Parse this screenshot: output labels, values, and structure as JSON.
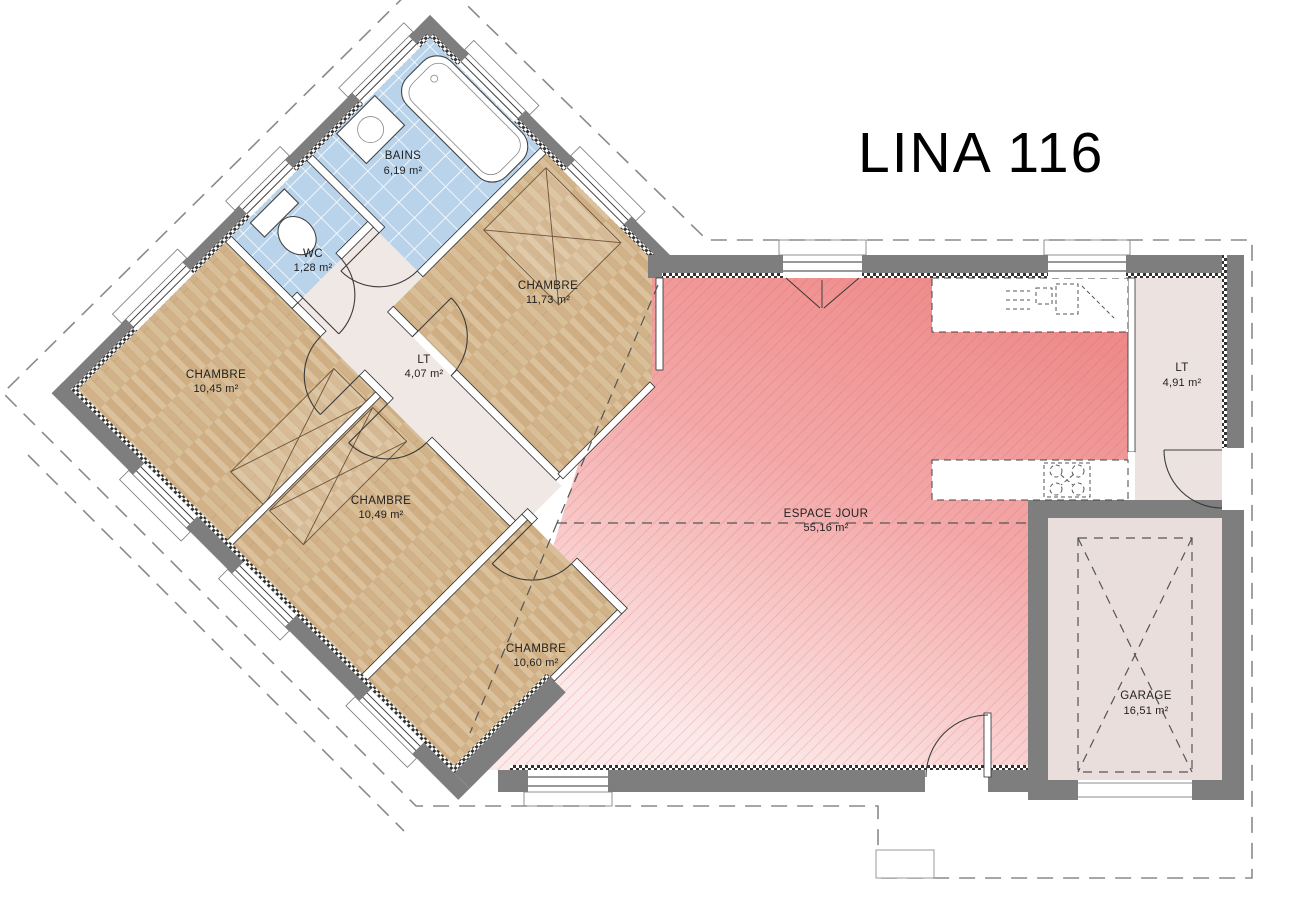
{
  "title": "LINA 116",
  "rooms": [
    {
      "id": "bains",
      "name": "BAINS",
      "area": "6,19 m²"
    },
    {
      "id": "wc",
      "name": "WC",
      "area": "1,28 m²"
    },
    {
      "id": "chambre-1",
      "name": "CHAMBRE",
      "area": "11,73 m²"
    },
    {
      "id": "lt-1",
      "name": "LT",
      "area": "4,07 m²"
    },
    {
      "id": "chambre-2",
      "name": "CHAMBRE",
      "area": "10,45 m²"
    },
    {
      "id": "chambre-3",
      "name": "CHAMBRE",
      "area": "10,49 m²"
    },
    {
      "id": "chambre-4",
      "name": "CHAMBRE",
      "area": "10,60 m²"
    },
    {
      "id": "espace-jour",
      "name": "ESPACE JOUR",
      "area": "55,16 m²"
    },
    {
      "id": "lt-2",
      "name": "LT",
      "area": "4,91 m²"
    },
    {
      "id": "garage",
      "name": "GARAGE",
      "area": "16,51 m²"
    }
  ],
  "colors": {
    "wall": "#7e7e7e",
    "wood_floor": "#d7bd94",
    "tile_floor": "#b9d3eb",
    "living_pink": "#ef8d8d",
    "annex_beige": "#ece3e1"
  }
}
